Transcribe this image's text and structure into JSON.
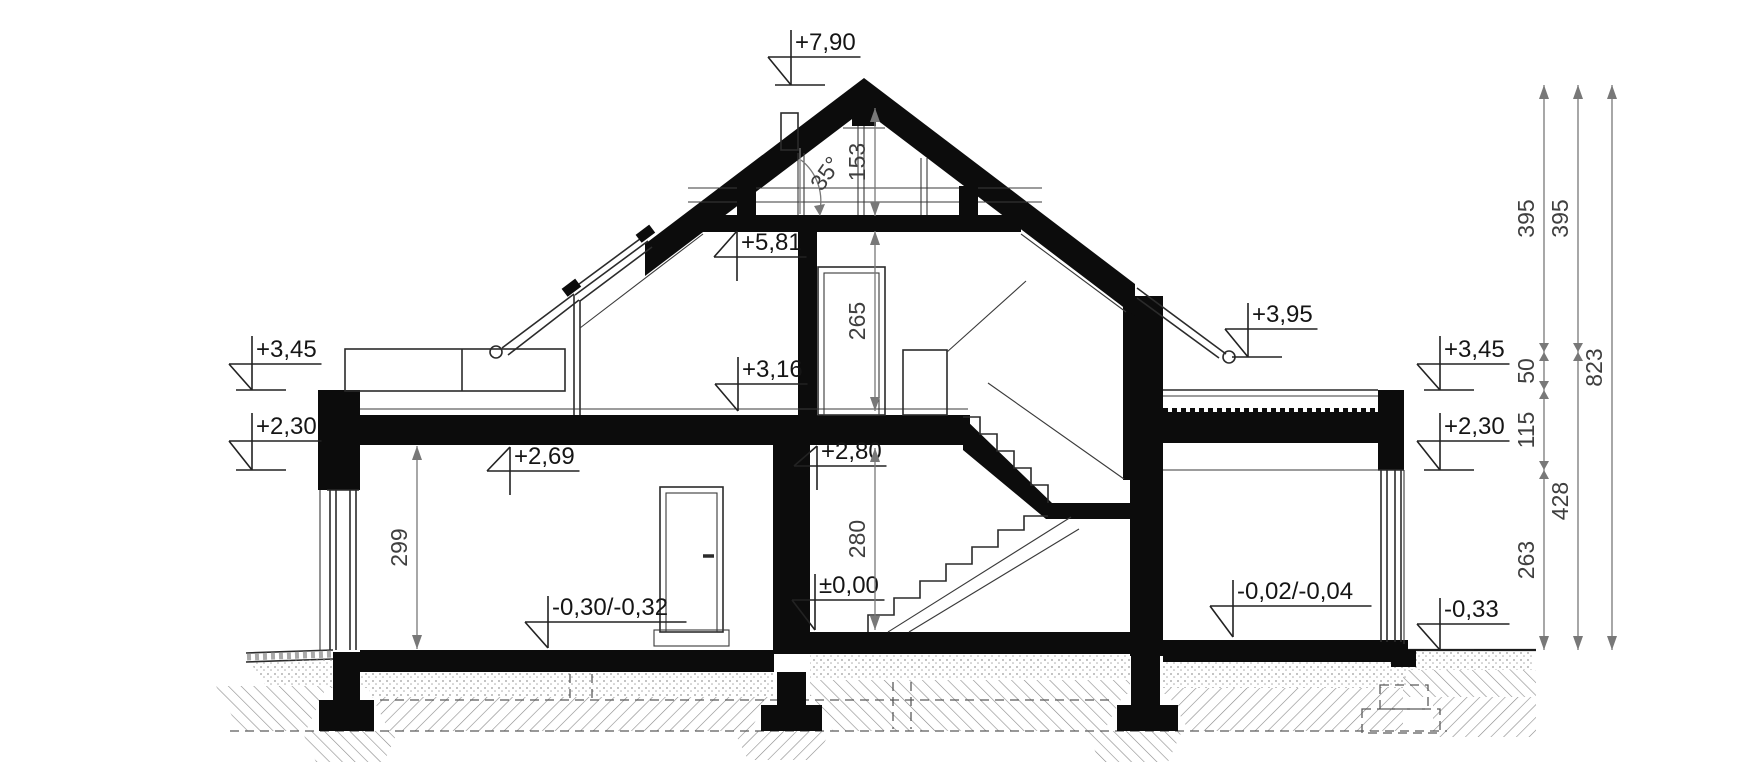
{
  "annotations": {
    "elevation_markers": [
      {
        "id": "ridge",
        "label": "+7,90"
      },
      {
        "id": "attic-ceiling",
        "label": "+5,81"
      },
      {
        "id": "left-eave",
        "label": "+3,45"
      },
      {
        "id": "left-ceiling-beam",
        "label": "+2,30"
      },
      {
        "id": "left-room-ceiling",
        "label": "+2,69"
      },
      {
        "id": "attic-floor",
        "label": "+3,16"
      },
      {
        "id": "attic-slab-underside",
        "label": "+2,80"
      },
      {
        "id": "right-eave",
        "label": "+3,95"
      },
      {
        "id": "right-parapet",
        "label": "+3,45"
      },
      {
        "id": "right-beam",
        "label": "+2,30"
      },
      {
        "id": "ground-floor",
        "label": "±0,00"
      },
      {
        "id": "left-room-floor",
        "label": "-0,30/-0,32"
      },
      {
        "id": "right-room-floor",
        "label": "-0,02/-0,04"
      },
      {
        "id": "exterior-grade",
        "label": "-0,33"
      }
    ],
    "interior_dimensions": [
      {
        "id": "gable-height",
        "label": "153"
      },
      {
        "id": "attic-room-height",
        "label": "265"
      },
      {
        "id": "stair-hall-height",
        "label": "280"
      },
      {
        "id": "left-room-height",
        "label": "299"
      }
    ],
    "right_dimension_chains": [
      {
        "id": "chain-1",
        "segments": [
          "395",
          "50",
          "115",
          "263"
        ]
      },
      {
        "id": "chain-2",
        "segments": [
          "395",
          "428"
        ]
      },
      {
        "id": "chain-3",
        "segments": [
          "823"
        ]
      }
    ],
    "roof_angle": {
      "label": "35°"
    }
  },
  "colors": {
    "background": "#ffffff",
    "structure_black": "#0c0c0c",
    "line_dark": "#2b2b2b",
    "dimension_gray": "#787878",
    "hatch_gray": "#8a8a8a"
  }
}
